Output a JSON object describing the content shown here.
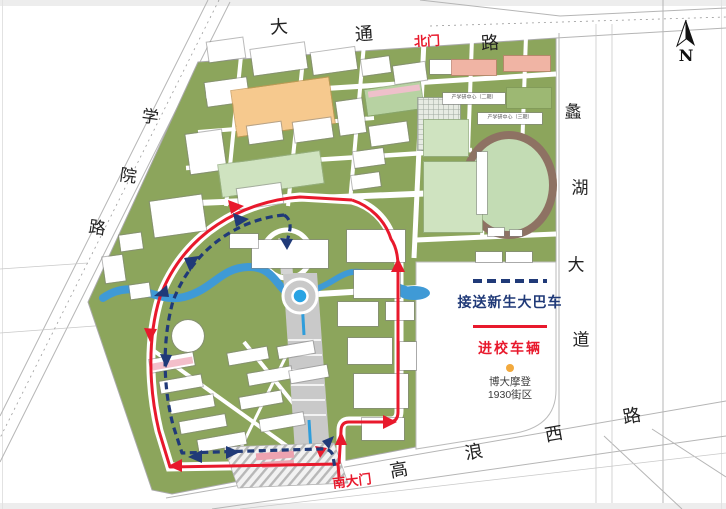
{
  "colors": {
    "campus_green": "#8ca55c",
    "bus_route_blue": "#203a78",
    "vehicle_route_red": "#e8192c",
    "river_blue": "#3f9ad6",
    "roundabout_blue": "#29a3e3",
    "poi_dot_orange": "#f2a93d"
  },
  "compass_label": "N",
  "road_names": {
    "top": "大通路",
    "left": "学院路",
    "right": "蠡湖大道",
    "bottom": "高浪西路"
  },
  "gate_labels": {
    "north": "北门",
    "south": "南大门"
  },
  "legend": {
    "bus_route_label": "接送新生大巴车",
    "vehicle_route_label": "进校车辆"
  },
  "poi": {
    "line1": "博大摩登",
    "line2": "1930街区"
  },
  "labels": [
    {
      "n": "road-top-char",
      "t": "大",
      "x": 279,
      "y": 28,
      "s": 18,
      "c": "#222",
      "b": 0,
      "r": -4,
      "f": 1
    },
    {
      "n": "road-top-char",
      "t": "通",
      "x": 364,
      "y": 35,
      "s": 18,
      "c": "#222",
      "b": 0,
      "r": -4,
      "f": 1
    },
    {
      "n": "north-gate-label",
      "t": "北门",
      "x": 427,
      "y": 41,
      "s": 13,
      "c": "#e8192c",
      "b": 1,
      "r": -3,
      "f": 0
    },
    {
      "n": "road-top-char",
      "t": "路",
      "x": 490,
      "y": 44,
      "s": 18,
      "c": "#222",
      "b": 0,
      "r": -4,
      "f": 1
    },
    {
      "n": "road-left-char",
      "t": "学",
      "x": 150,
      "y": 118,
      "s": 17,
      "c": "#222",
      "b": 0,
      "r": 8,
      "f": 1
    },
    {
      "n": "road-left-char",
      "t": "院",
      "x": 128,
      "y": 177,
      "s": 17,
      "c": "#222",
      "b": 0,
      "r": 8,
      "f": 1
    },
    {
      "n": "road-left-char",
      "t": "路",
      "x": 97,
      "y": 229,
      "s": 17,
      "c": "#222",
      "b": 0,
      "r": 8,
      "f": 1
    },
    {
      "n": "road-right-char",
      "t": "蠡",
      "x": 573,
      "y": 113,
      "s": 17,
      "c": "#222",
      "b": 0,
      "r": 0,
      "f": 1
    },
    {
      "n": "road-right-char",
      "t": "湖",
      "x": 580,
      "y": 189,
      "s": 17,
      "c": "#222",
      "b": 0,
      "r": 0,
      "f": 1
    },
    {
      "n": "road-right-char",
      "t": "大",
      "x": 576,
      "y": 266,
      "s": 17,
      "c": "#222",
      "b": 0,
      "r": 0,
      "f": 1
    },
    {
      "n": "road-right-char",
      "t": "道",
      "x": 581,
      "y": 341,
      "s": 17,
      "c": "#222",
      "b": 0,
      "r": 0,
      "f": 1
    },
    {
      "n": "road-bottom-char",
      "t": "高",
      "x": 399,
      "y": 471,
      "s": 18,
      "c": "#222",
      "b": 0,
      "r": -10,
      "f": 1
    },
    {
      "n": "road-bottom-char",
      "t": "浪",
      "x": 474,
      "y": 453,
      "s": 18,
      "c": "#222",
      "b": 0,
      "r": -10,
      "f": 1
    },
    {
      "n": "road-bottom-char",
      "t": "西",
      "x": 554,
      "y": 435,
      "s": 18,
      "c": "#222",
      "b": 0,
      "r": -10,
      "f": 1
    },
    {
      "n": "road-bottom-char",
      "t": "路",
      "x": 632,
      "y": 417,
      "s": 18,
      "c": "#222",
      "b": 0,
      "r": -10,
      "f": 1
    },
    {
      "n": "south-gate-label",
      "t": "南大门",
      "x": 352,
      "y": 481,
      "s": 13,
      "c": "#e8192c",
      "b": 1,
      "r": -7,
      "f": 0
    },
    {
      "n": "building-label",
      "t": "产学研中心（二期）",
      "x": 474,
      "y": 98,
      "s": 5,
      "c": "#555",
      "b": 0,
      "r": 0,
      "f": 0
    },
    {
      "n": "building-label",
      "t": "产学研中心（三期）",
      "x": 510,
      "y": 118,
      "s": 5,
      "c": "#555",
      "b": 0,
      "r": 0,
      "f": 0
    }
  ],
  "map": {
    "buildings": [
      [
        208,
        40,
        36,
        20,
        -8,
        "w"
      ],
      [
        252,
        46,
        54,
        26,
        -8,
        "w"
      ],
      [
        312,
        50,
        44,
        22,
        -8,
        "w"
      ],
      [
        206,
        80,
        42,
        24,
        -8,
        "w"
      ],
      [
        362,
        58,
        28,
        16,
        -8,
        "w"
      ],
      [
        234,
        84,
        98,
        46,
        -8,
        "o"
      ],
      [
        248,
        124,
        34,
        18,
        -8,
        "w"
      ],
      [
        294,
        120,
        38,
        20,
        -8,
        "w"
      ],
      [
        338,
        100,
        26,
        34,
        -8,
        "w"
      ],
      [
        188,
        132,
        36,
        40,
        -8,
        "w"
      ],
      [
        220,
        158,
        102,
        32,
        -8,
        "g"
      ],
      [
        238,
        186,
        44,
        20,
        -8,
        "w"
      ],
      [
        152,
        198,
        52,
        36,
        -8,
        "w"
      ],
      [
        120,
        234,
        22,
        16,
        -8,
        "w"
      ],
      [
        104,
        256,
        20,
        26,
        -8,
        "w"
      ],
      [
        130,
        284,
        20,
        14,
        -8,
        "w"
      ],
      [
        394,
        64,
        32,
        18,
        -8,
        "w"
      ],
      [
        366,
        86,
        56,
        26,
        -8,
        "c"
      ],
      [
        370,
        124,
        38,
        20,
        -8,
        "w"
      ],
      [
        354,
        150,
        30,
        16,
        -8,
        "w"
      ],
      [
        352,
        174,
        28,
        14,
        -8,
        "w"
      ],
      [
        418,
        98,
        42,
        52,
        0,
        "y"
      ],
      [
        430,
        60,
        26,
        14,
        0,
        "w"
      ],
      [
        452,
        60,
        44,
        15,
        0,
        "p"
      ],
      [
        504,
        56,
        46,
        15,
        0,
        "p"
      ],
      [
        443,
        93,
        62,
        11,
        0,
        "w"
      ],
      [
        507,
        88,
        44,
        20,
        0,
        "v"
      ],
      [
        478,
        113,
        64,
        11,
        0,
        "w"
      ],
      [
        424,
        120,
        44,
        36,
        0,
        "g"
      ],
      [
        424,
        162,
        58,
        70,
        0,
        "g"
      ],
      [
        477,
        152,
        10,
        62,
        0,
        "w"
      ],
      [
        488,
        228,
        16,
        8,
        0,
        "w"
      ],
      [
        510,
        230,
        12,
        6,
        0,
        "w"
      ],
      [
        252,
        240,
        76,
        28,
        0,
        "w"
      ],
      [
        347,
        230,
        58,
        32,
        0,
        "w"
      ],
      [
        354,
        270,
        46,
        28,
        0,
        "w"
      ],
      [
        230,
        234,
        28,
        14,
        0,
        "w"
      ],
      [
        172,
        320,
        32,
        32,
        0,
        "wr"
      ],
      [
        476,
        252,
        26,
        10,
        0,
        "w"
      ],
      [
        506,
        252,
        26,
        10,
        0,
        "w"
      ],
      [
        150,
        356,
        44,
        13,
        -10,
        "w"
      ],
      [
        160,
        378,
        42,
        12,
        -10,
        "w"
      ],
      [
        170,
        398,
        44,
        12,
        -10,
        "w"
      ],
      [
        180,
        418,
        46,
        12,
        -10,
        "w"
      ],
      [
        198,
        436,
        48,
        12,
        -10,
        "w"
      ],
      [
        228,
        350,
        40,
        12,
        -10,
        "w"
      ],
      [
        248,
        370,
        44,
        12,
        -10,
        "w"
      ],
      [
        240,
        394,
        42,
        12,
        -10,
        "w"
      ],
      [
        260,
        416,
        44,
        12,
        -10,
        "w"
      ],
      [
        278,
        344,
        36,
        12,
        -10,
        "w"
      ],
      [
        290,
        368,
        38,
        12,
        -10,
        "w"
      ],
      [
        338,
        302,
        40,
        24,
        0,
        "w"
      ],
      [
        386,
        302,
        28,
        18,
        0,
        "w"
      ],
      [
        348,
        338,
        44,
        26,
        0,
        "w"
      ],
      [
        354,
        374,
        54,
        34,
        0,
        "w"
      ],
      [
        362,
        418,
        42,
        22,
        0,
        "w"
      ],
      [
        400,
        342,
        16,
        28,
        0,
        "w"
      ]
    ],
    "strips": [
      [
        368,
        88,
        52,
        6,
        -8,
        "#eec0ca"
      ],
      [
        152,
        360,
        41,
        7,
        -10,
        "#f3bfca"
      ],
      [
        256,
        452,
        38,
        7,
        -4,
        "#eda3b0"
      ],
      [
        262,
        461,
        32,
        6,
        -4,
        "#eda3b0"
      ]
    ]
  }
}
